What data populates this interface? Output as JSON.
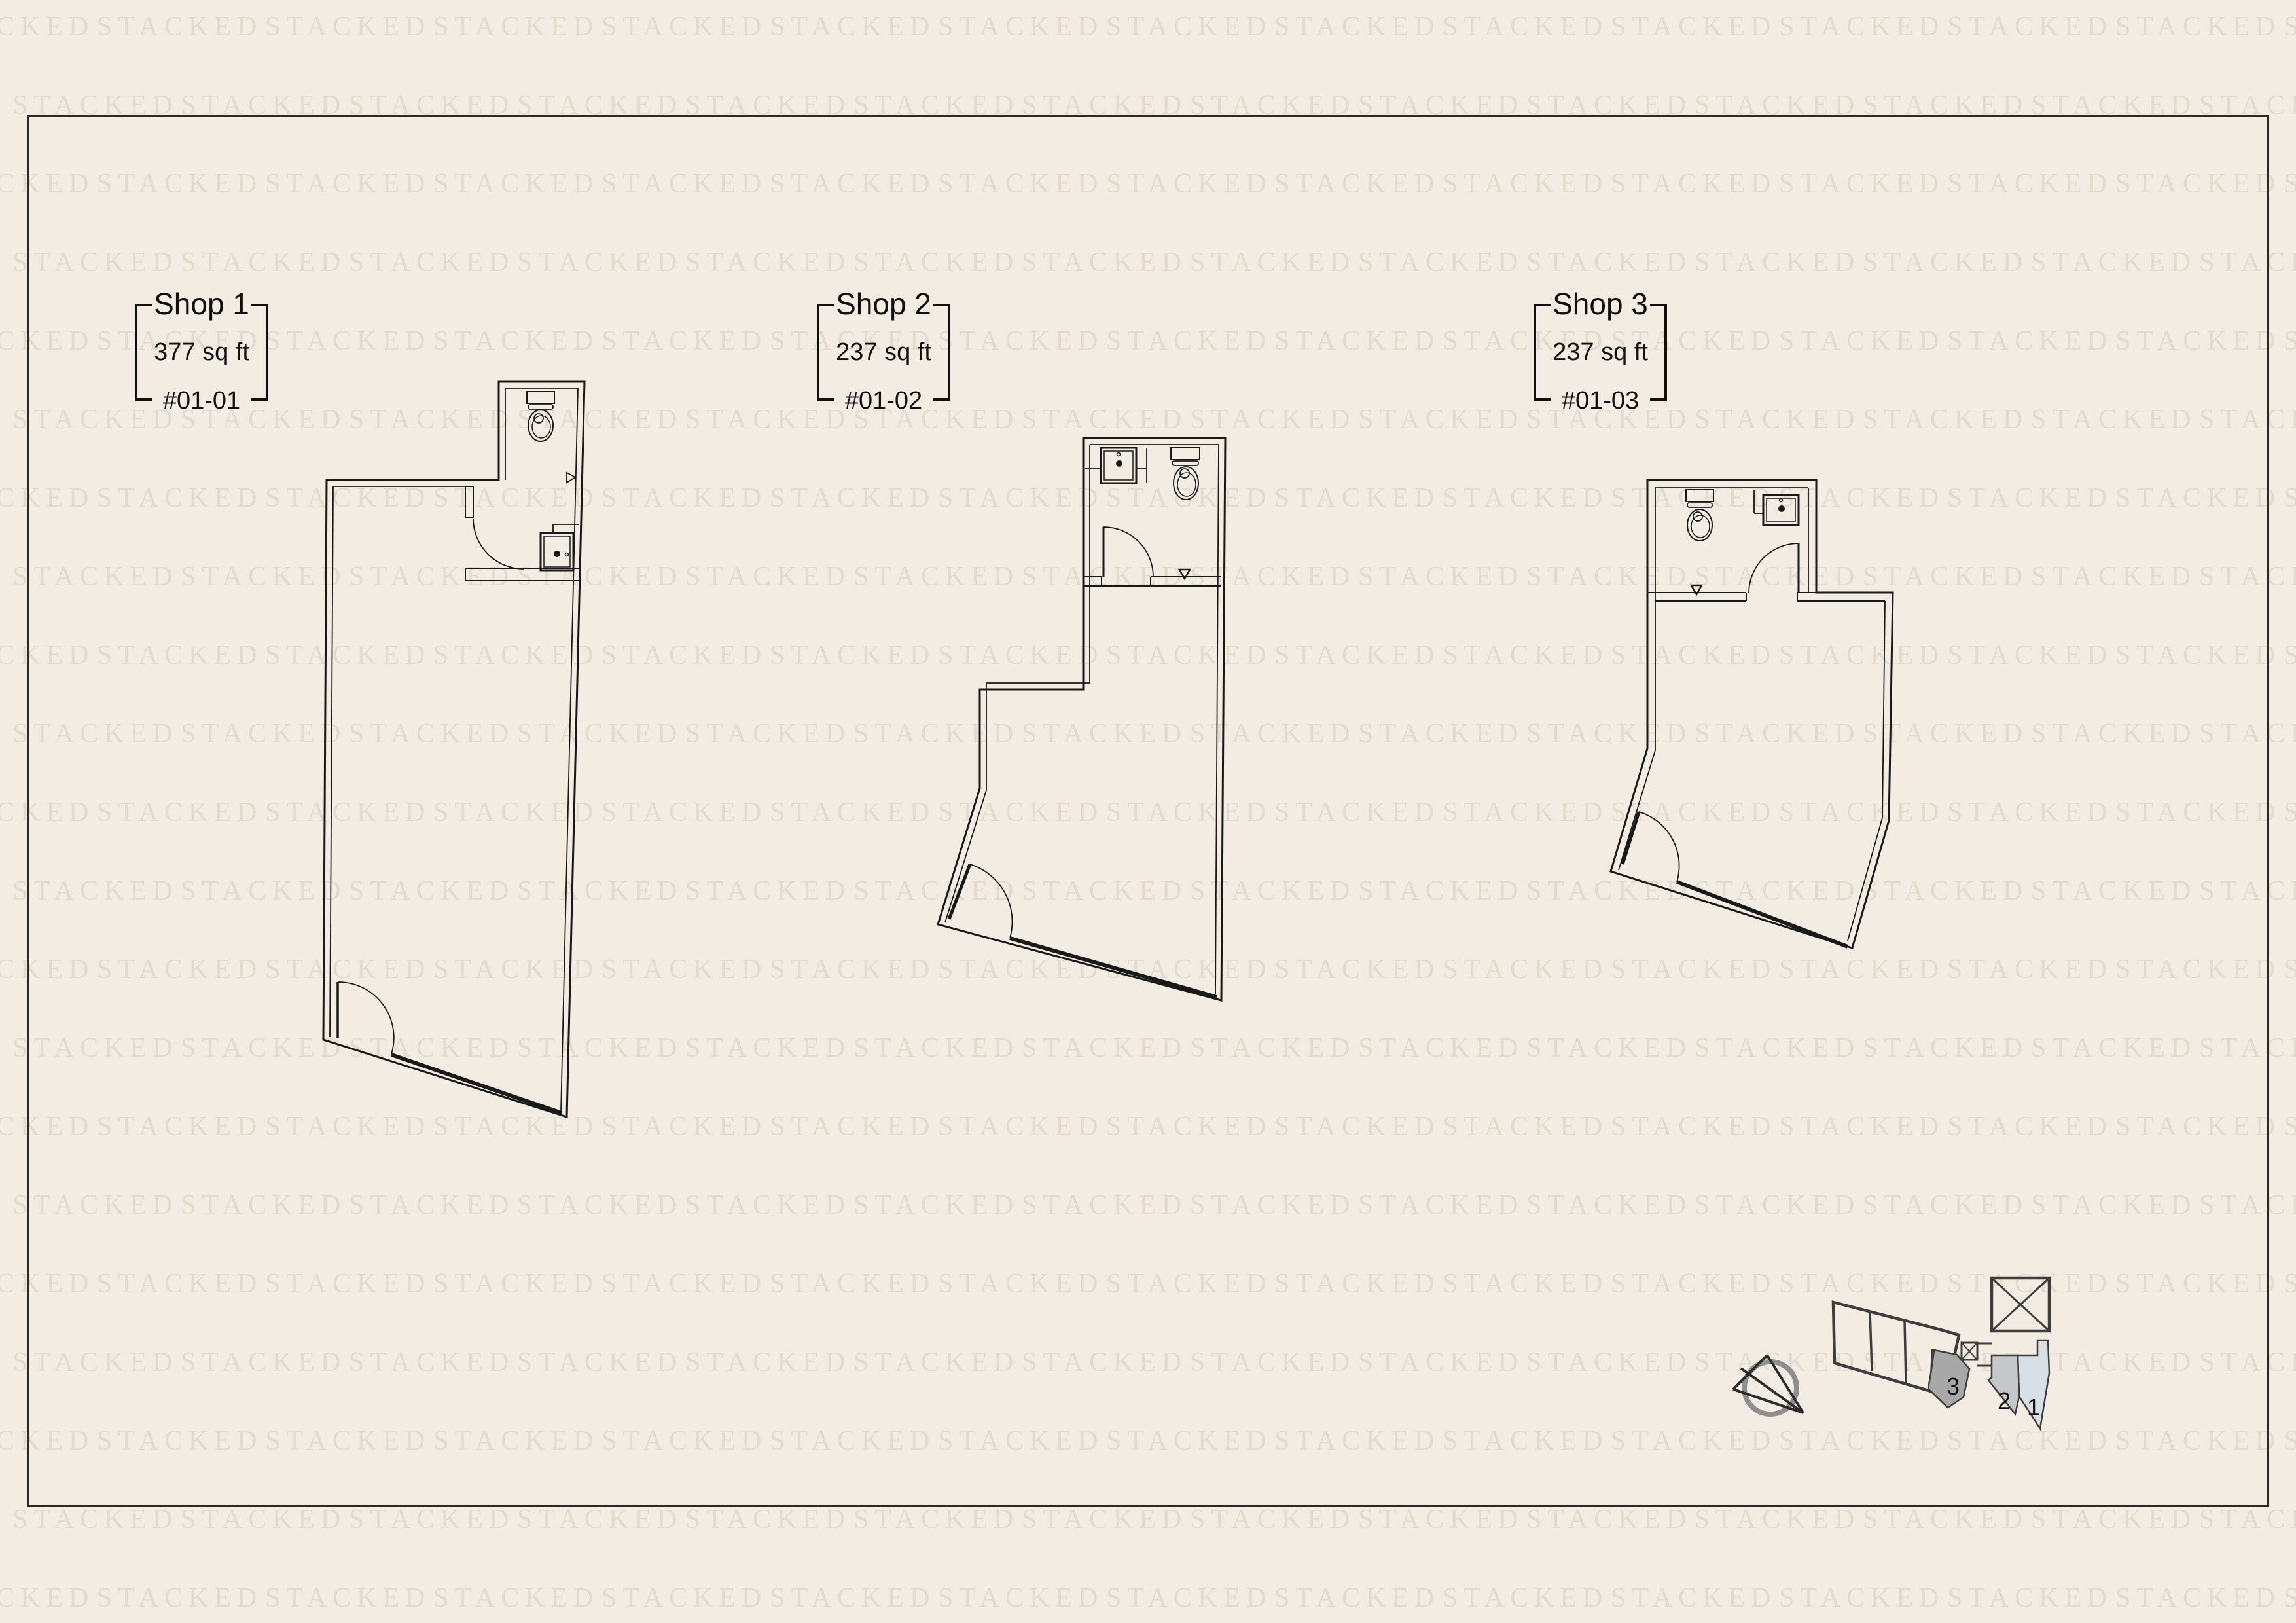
{
  "watermark": {
    "text": "STACKED",
    "color": "#e4dbcf"
  },
  "theme": {
    "background": "#f2ece2",
    "frame_border": "#2c2824",
    "plan_line": "#191919",
    "key_plan_line": "#3d3d3d",
    "compass_ring": "#8e8e8e"
  },
  "units": [
    {
      "name": "Shop 1",
      "area": "377 sq ft",
      "unit_number": "#01-01"
    },
    {
      "name": "Shop 2",
      "area": "237 sq ft",
      "unit_number": "#01-02"
    },
    {
      "name": "Shop 3",
      "area": "237 sq ft",
      "unit_number": "#01-03"
    }
  ],
  "key_plan": {
    "unit_labels": [
      "3",
      "2",
      "1"
    ],
    "highlight_colors": {
      "unit_3": "#a8a8a8",
      "unit_2": "#c4c8cb",
      "unit_1": "#d9e0e5"
    }
  }
}
